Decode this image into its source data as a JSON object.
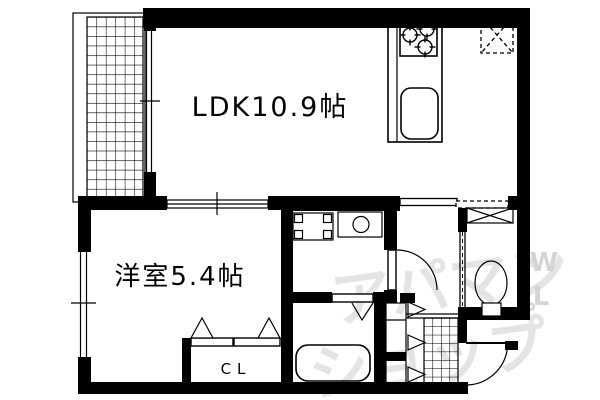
{
  "rooms": {
    "ldk": {
      "label": "LDK10.9帖",
      "size_jo": "10.9"
    },
    "bedroom": {
      "label": "洋室5.4帖",
      "size_jo": "5.4"
    },
    "closet": {
      "label": "CL"
    }
  },
  "watermark": {
    "line1": "アパマン",
    "line2": "ショップ",
    "letter1": "W",
    "letter2": "L",
    "mark": "゜"
  },
  "colors": {
    "wall": "#000000",
    "background": "#ffffff",
    "watermark": "#e4e4e4",
    "watermark_letters": "#d4d4d4"
  },
  "icons": {
    "balcony-hatch": "grid-hatched balcony floor",
    "ldk-window": "double-line sliding window with center tick",
    "bedroom-window": "double-line sliding window with center tick",
    "room-divider": "double sliding door between LDK and bedroom",
    "hall-slider": "sliding door with dashed track",
    "stove": "three-burner gas stove",
    "kitchen-sink": "rounded kitchen sink",
    "refrigerator-space": "dashed box with X",
    "washer-pan": "washing machine pan with corner pads",
    "wash-basin": "vanity counter with round basin",
    "toilet": "toilet bowl with base",
    "toilet-shelf": "X-crossed shelf box",
    "bathtub": "rounded bathtub",
    "bath-door": "folding door V mark",
    "closet-doors": "bi-fold closet doors with triangles",
    "shoe-cabinet": "shoe cabinet with door chevrons",
    "entry-tile": "grid-hatched entry floor with step lines",
    "entry-door": "front door with swing arc",
    "washroom-door": "hinged door with swing arc"
  }
}
